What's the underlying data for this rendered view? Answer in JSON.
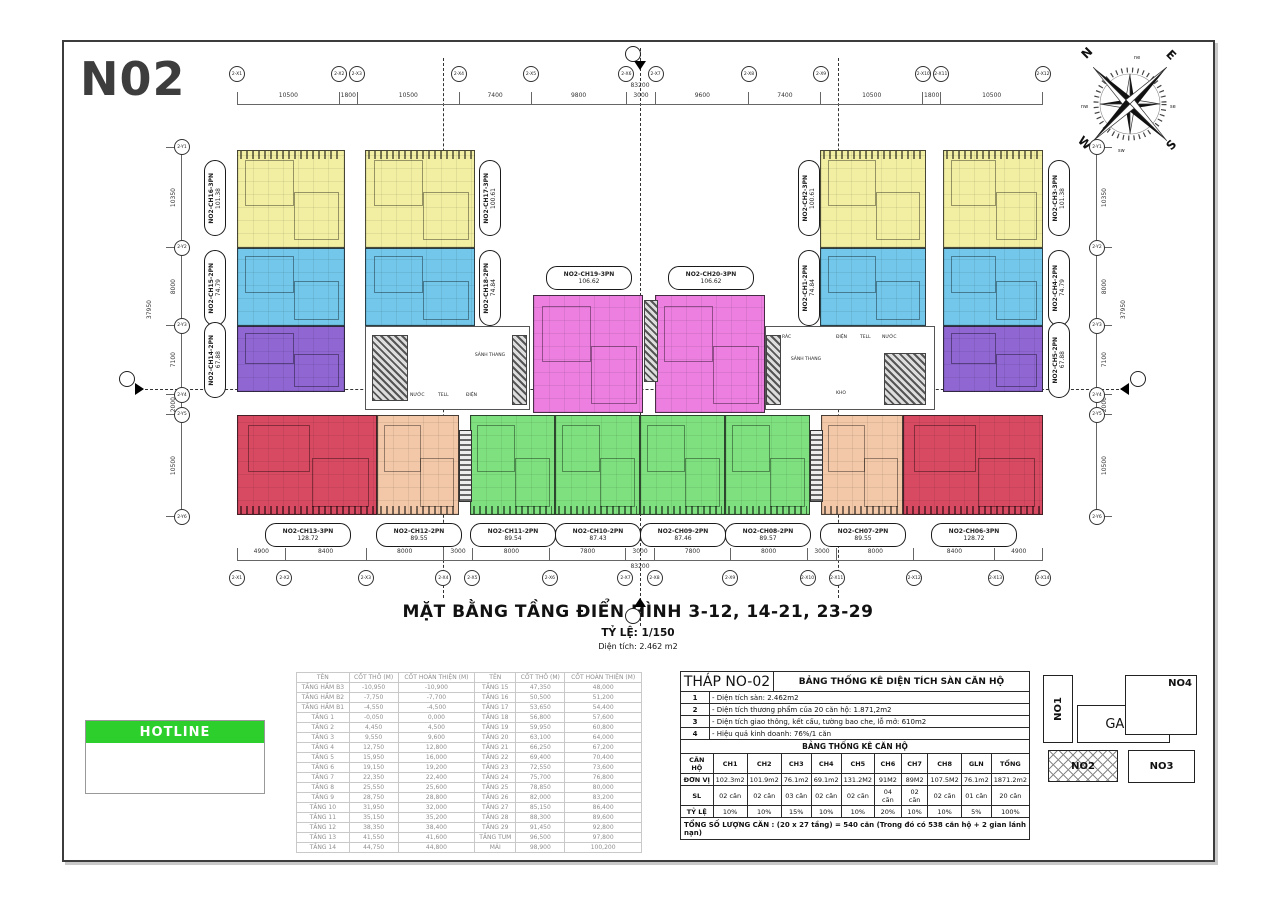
{
  "sheet": {
    "code": "N02"
  },
  "plan_title": {
    "main": "MẶT BẰNG TẦNG ĐIỂN HÌNH 3-12, 14-21, 23-29",
    "scale": "TỶ LỆ: 1/150",
    "area": "Diện tích: 2.462 m2"
  },
  "compass": {
    "cardinals": [
      "N",
      "E",
      "S",
      "W"
    ],
    "intercardinals": [
      "ne",
      "se",
      "sw",
      "nw"
    ]
  },
  "dimensions": {
    "top": [
      "10500",
      "1800",
      "10500",
      "7400",
      "9800",
      "3000",
      "9600",
      "7400",
      "10500",
      "1800",
      "10500"
    ],
    "top_total": "83200",
    "bottom": [
      "4900",
      "8400",
      "8000",
      "3000",
      "8000",
      "7800",
      "3000",
      "7800",
      "8000",
      "3000",
      "8000",
      "8400",
      "4900"
    ],
    "bottom_total": "83200",
    "left": [
      "10350",
      "8000",
      "7100",
      "2000",
      "10500"
    ],
    "left_total": "37950",
    "right": [
      "10350",
      "8000",
      "7100",
      "2000",
      "10500"
    ],
    "right_total": "37950"
  },
  "grid": {
    "top": [
      "2-X1",
      "2-X2",
      "2-X3",
      "2-X4",
      "2-X5",
      "2-X6",
      "2-X7",
      "2-X8",
      "2-X9",
      "2-X10",
      "2-X11",
      "2-X12"
    ],
    "bottom": [
      "2-X1",
      "2-X2",
      "2-X3",
      "2-X4",
      "2-X5",
      "2-X6",
      "2-X7",
      "2-X8",
      "2-X9",
      "2-X10",
      "2-X11",
      "2-X12",
      "2-X13",
      "2-X14"
    ],
    "left": [
      "2-Y1",
      "2-Y2",
      "2-Y3",
      "2-Y4",
      "2-Y5",
      "2-Y6"
    ],
    "right": [
      "2-Y1",
      "2-Y2",
      "2-Y3",
      "2-Y4",
      "2-Y5",
      "2-Y6"
    ]
  },
  "units": [
    {
      "name": "NO2-CH16-3PN",
      "area": "101.38",
      "color": "#F2EFA3"
    },
    {
      "name": "NO2-CH15-2PN",
      "area": "74.79",
      "color": "#72C7EA"
    },
    {
      "name": "NO2-CH14-2PN",
      "area": "67.88",
      "color": "#8F66D2"
    },
    {
      "name": "NO2-CH17-3PN",
      "area": "100.61",
      "color": "#F2EFA3"
    },
    {
      "name": "NO2-CH18-2PN",
      "area": "74.84",
      "color": "#72C7EA"
    },
    {
      "name": "NO2-CH19-3PN",
      "area": "106.62",
      "color": "#EC7FE0"
    },
    {
      "name": "NO2-CH20-3PN",
      "area": "106.62",
      "color": "#EC7FE0"
    },
    {
      "name": "NO2-CH2-3PN",
      "area": "100.61",
      "color": "#F2EFA3"
    },
    {
      "name": "NO2-CH1-2PN",
      "area": "74.84",
      "color": "#72C7EA"
    },
    {
      "name": "NO2-CH3-3PN",
      "area": "101.38",
      "color": "#F2EFA3"
    },
    {
      "name": "NO2-CH4-2PN",
      "area": "74.79",
      "color": "#72C7EA"
    },
    {
      "name": "NO2-CH5-2PN",
      "area": "67.88",
      "color": "#8F66D2"
    },
    {
      "name": "NO2-CH13-3PN",
      "area": "128.72",
      "color": "#D84A62"
    },
    {
      "name": "NO2-CH12-2PN",
      "area": "89.55",
      "color": "#F2C8A8"
    },
    {
      "name": "NO2-CH11-2PN",
      "area": "89.54",
      "color": "#7FE07F"
    },
    {
      "name": "NO2-CH10-2PN",
      "area": "87.43",
      "color": "#7FE07F"
    },
    {
      "name": "NO2-CH09-2PN",
      "area": "87.46",
      "color": "#7FE07F"
    },
    {
      "name": "NO2-CH08-2PN",
      "area": "89.57",
      "color": "#7FE07F"
    },
    {
      "name": "NO2-CH07-2PN",
      "area": "89.55",
      "color": "#F2C8A8"
    },
    {
      "name": "NO2-CH06-3PN",
      "area": "128.72",
      "color": "#D84A62"
    }
  ],
  "core_labels": {
    "left": [
      "NƯỚC",
      "TELL",
      "ĐIỆN",
      "SẢNH THANG"
    ],
    "right": [
      "RÁC",
      "SẢNH THANG",
      "ĐIỆN",
      "TELL",
      "NƯỚC",
      "KHO"
    ]
  },
  "hotline": {
    "label": "HOTLINE",
    "color": "#2DCF2D"
  },
  "floor_table": {
    "headers": [
      "TÊN",
      "CỐT THÔ (M)",
      "CỐT HOÀN THIỆN (M)",
      "TÊN",
      "CỐT THÔ (M)",
      "CỐT HOÀN THIỆN (M)"
    ],
    "rows": [
      [
        "TẦNG HẦM B3",
        "-10,950",
        "-10,900",
        "TẦNG 15",
        "47,350",
        "48,000"
      ],
      [
        "TẦNG HẦM B2",
        "-7,750",
        "-7,700",
        "TẦNG 16",
        "50,500",
        "51,200"
      ],
      [
        "TẦNG HẦM B1",
        "-4,550",
        "-4,500",
        "TẦNG 17",
        "53,650",
        "54,400"
      ],
      [
        "TẦNG 1",
        "-0,050",
        "0,000",
        "TẦNG 18",
        "56,800",
        "57,600"
      ],
      [
        "TẦNG 2",
        "4,450",
        "4,500",
        "TẦNG 19",
        "59,950",
        "60,800"
      ],
      [
        "TẦNG 3",
        "9,550",
        "9,600",
        "TẦNG 20",
        "63,100",
        "64,000"
      ],
      [
        "TẦNG 4",
        "12,750",
        "12,800",
        "TẦNG 21",
        "66,250",
        "67,200"
      ],
      [
        "TẦNG 5",
        "15,950",
        "16,000",
        "TẦNG 22",
        "69,400",
        "70,400"
      ],
      [
        "TẦNG 6",
        "19,150",
        "19,200",
        "TẦNG 23",
        "72,550",
        "73,600"
      ],
      [
        "TẦNG 7",
        "22,350",
        "22,400",
        "TẦNG 24",
        "75,700",
        "76,800"
      ],
      [
        "TẦNG 8",
        "25,550",
        "25,600",
        "TẦNG 25",
        "78,850",
        "80,000"
      ],
      [
        "TẦNG 9",
        "28,750",
        "28,800",
        "TẦNG 26",
        "82,000",
        "83,200"
      ],
      [
        "TẦNG 10",
        "31,950",
        "32,000",
        "TẦNG 27",
        "85,150",
        "86,400"
      ],
      [
        "TẦNG 11",
        "35,150",
        "35,200",
        "TẦNG 28",
        "88,300",
        "89,600"
      ],
      [
        "TẦNG 12",
        "38,350",
        "38,400",
        "TẦNG 29",
        "91,450",
        "92,800"
      ],
      [
        "TẦNG 13",
        "41,550",
        "41,600",
        "TẦNG TUM",
        "96,500",
        "97,800"
      ],
      [
        "TẦNG 14",
        "44,750",
        "44,800",
        "MÁI",
        "98,900",
        "100,200"
      ]
    ]
  },
  "stats_table": {
    "tower": "THÁP NO-02",
    "title": "BẢNG THỐNG KÊ DIỆN TÍCH SÀN CĂN HỘ",
    "notes": [
      [
        "1",
        "- Diện tích sàn: 2.462m2"
      ],
      [
        "2",
        "- Diện tích thương phẩm của 20 căn hộ: 1.871,2m2"
      ],
      [
        "3",
        "- Diện tích giao thông, kết cấu, tường bao che, lỗ mở: 610m2"
      ],
      [
        "4",
        "- Hiệu quả kinh doanh: 76%/1 căn"
      ]
    ],
    "sub_title": "BẢNG THỐNG KÊ CĂN HỘ",
    "unit_headers": [
      "CĂN HỘ",
      "CH1",
      "CH2",
      "CH3",
      "CH4",
      "CH5",
      "CH6",
      "CH7",
      "CH8",
      "GLN",
      "TỔNG"
    ],
    "unit_rows": [
      [
        "ĐƠN VỊ",
        "102.3m2",
        "101.9m2",
        "76.1m2",
        "69.1m2",
        "131.2M2",
        "91M2",
        "89M2",
        "107.5M2",
        "76.1m2",
        "1871.2m2"
      ],
      [
        "SL",
        "02 căn",
        "02 căn",
        "03 căn",
        "02 căn",
        "02 căn",
        "04 căn",
        "02 căn",
        "02 căn",
        "01 căn",
        "20 căn"
      ],
      [
        "TỶ LỆ",
        "10%",
        "10%",
        "15%",
        "10%",
        "10%",
        "20%",
        "10%",
        "10%",
        "5%",
        "100%"
      ]
    ],
    "footer": "TỔNG SỐ LƯỢNG CĂN : (20 x 27 tầng) = 540 căn (Trong đó có 538 căn hộ + 2 gian lánh nạn)"
  },
  "site_plan": {
    "buildings": [
      "NO1",
      "GARA",
      "NO4",
      "NO2",
      "NO3"
    ]
  }
}
